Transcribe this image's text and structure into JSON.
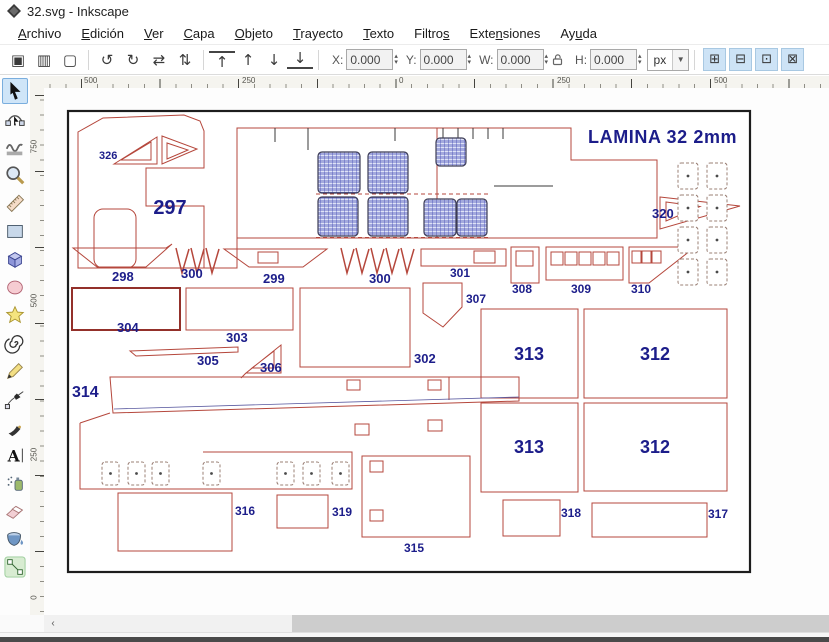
{
  "window": {
    "title": "32.svg - Inkscape"
  },
  "menu": {
    "items": [
      {
        "label": "Archivo",
        "u": 0
      },
      {
        "label": "Edición",
        "u": 0
      },
      {
        "label": "Ver",
        "u": 0
      },
      {
        "label": "Capa",
        "u": 0
      },
      {
        "label": "Objeto",
        "u": 0
      },
      {
        "label": "Trayecto",
        "u": 0
      },
      {
        "label": "Texto",
        "u": 0
      },
      {
        "label": "Filtros",
        "u": 6
      },
      {
        "label": "Extensiones",
        "u": 4
      },
      {
        "label": "Ayuda",
        "u": 2
      }
    ]
  },
  "toolbar": {
    "icon_groups": [
      [
        "select-all",
        "select-all-layers",
        "deselect"
      ],
      [
        "rotate-ccw",
        "rotate-cw",
        "flip-horizontal",
        "flip-vertical"
      ],
      [
        "raise-to-top",
        "raise",
        "lower",
        "lower-to-bottom"
      ]
    ],
    "fields": [
      {
        "label": "X:",
        "value": "0.000"
      },
      {
        "label": "Y:",
        "value": "0.000"
      },
      {
        "label": "W:",
        "value": "0.000"
      },
      {
        "label": "H:",
        "value": "0.000"
      }
    ],
    "unit": "px",
    "toggle_icons": [
      "move-pattern-toggle",
      "move-gradient-toggle",
      "move-clip-toggle",
      "scale-stroke-toggle"
    ]
  },
  "toolbox": {
    "active": 0,
    "overflow": "»",
    "tools": [
      "selector",
      "node-editor",
      "tweak",
      "zoom",
      "measure",
      "rectangle",
      "box-3d",
      "ellipse",
      "star",
      "spiral",
      "pencil",
      "bezier-pen",
      "calligraphy",
      "text",
      "spray",
      "eraser",
      "paint-bucket",
      "connector"
    ]
  },
  "rulers": {
    "horizontal": [
      {
        "t": "500",
        "x": 82
      },
      {
        "t": "250",
        "x": 240
      },
      {
        "t": "0",
        "x": 397
      },
      {
        "t": "250",
        "x": 555
      },
      {
        "t": "500",
        "x": 712
      }
    ],
    "vertical": [
      {
        "t": "750",
        "y": 152
      },
      {
        "t": "500",
        "y": 306
      },
      {
        "t": "250",
        "y": 460
      },
      {
        "t": "0",
        "y": 603
      }
    ]
  },
  "scrollbar": {
    "left_arrow": "‹"
  },
  "canvas": {
    "sheet_title": "LAMINA 32 2mm",
    "label_color": "#1c1d8a",
    "outline_color": "#b5473c",
    "labels": [
      {
        "t": "LAMINA 32 2mm",
        "x": 588,
        "y": 143,
        "s": 18,
        "ls": 0.6
      },
      {
        "t": "326",
        "x": 99,
        "y": 159,
        "s": 11
      },
      {
        "t": "297",
        "x": 170,
        "y": 214,
        "s": 20,
        "a": "m"
      },
      {
        "t": "320",
        "x": 652,
        "y": 218,
        "s": 13
      },
      {
        "t": "298",
        "x": 112,
        "y": 281,
        "s": 13
      },
      {
        "t": "300",
        "x": 181,
        "y": 278,
        "s": 13
      },
      {
        "t": "299",
        "x": 263,
        "y": 283,
        "s": 13
      },
      {
        "t": "300",
        "x": 369,
        "y": 283,
        "s": 13
      },
      {
        "t": "301",
        "x": 450,
        "y": 277,
        "s": 12
      },
      {
        "t": "308",
        "x": 512,
        "y": 293,
        "s": 12
      },
      {
        "t": "309",
        "x": 571,
        "y": 293,
        "s": 12
      },
      {
        "t": "310",
        "x": 631,
        "y": 293,
        "s": 12
      },
      {
        "t": "307",
        "x": 466,
        "y": 303,
        "s": 12
      },
      {
        "t": "304",
        "x": 117,
        "y": 332,
        "s": 13
      },
      {
        "t": "303",
        "x": 226,
        "y": 342,
        "s": 13
      },
      {
        "t": "305",
        "x": 197,
        "y": 365,
        "s": 13
      },
      {
        "t": "306",
        "x": 260,
        "y": 372,
        "s": 13
      },
      {
        "t": "302",
        "x": 414,
        "y": 363,
        "s": 13
      },
      {
        "t": "313",
        "x": 529,
        "y": 360,
        "s": 18,
        "a": "m"
      },
      {
        "t": "312",
        "x": 655,
        "y": 360,
        "s": 18,
        "a": "m"
      },
      {
        "t": "314",
        "x": 72,
        "y": 397,
        "s": 16
      },
      {
        "t": "313",
        "x": 529,
        "y": 453,
        "s": 18,
        "a": "m"
      },
      {
        "t": "312",
        "x": 655,
        "y": 453,
        "s": 18,
        "a": "m"
      },
      {
        "t": "316",
        "x": 235,
        "y": 515,
        "s": 12
      },
      {
        "t": "319",
        "x": 332,
        "y": 516,
        "s": 12
      },
      {
        "t": "315",
        "x": 404,
        "y": 552,
        "s": 12
      },
      {
        "t": "318",
        "x": 561,
        "y": 517,
        "s": 12
      },
      {
        "t": "317",
        "x": 708,
        "y": 518,
        "s": 12
      }
    ]
  }
}
